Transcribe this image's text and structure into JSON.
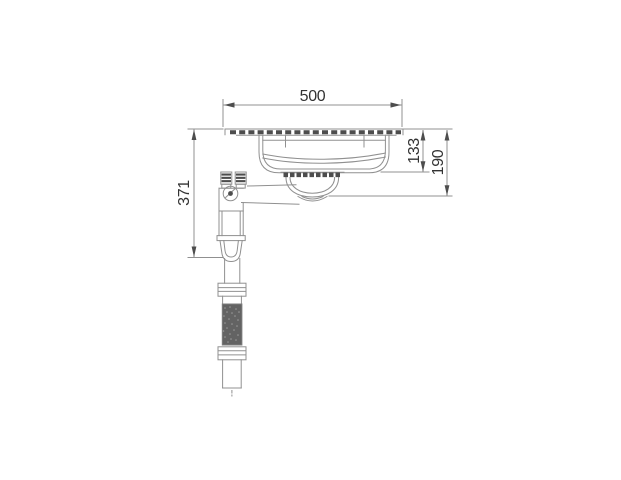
{
  "drawing": {
    "type": "technical-drawing",
    "units": "mm",
    "dimensions": {
      "overall_width": "500",
      "bowl_depth": "133",
      "outlet_depth": "190",
      "trap_height": "371"
    },
    "colors": {
      "line": "#909090",
      "dark_detail": "#4d4d4d",
      "hose_fill": "#636363",
      "hose_dot": "#9b9b9b",
      "dimension_text": "#333333",
      "background": "#ffffff"
    }
  }
}
